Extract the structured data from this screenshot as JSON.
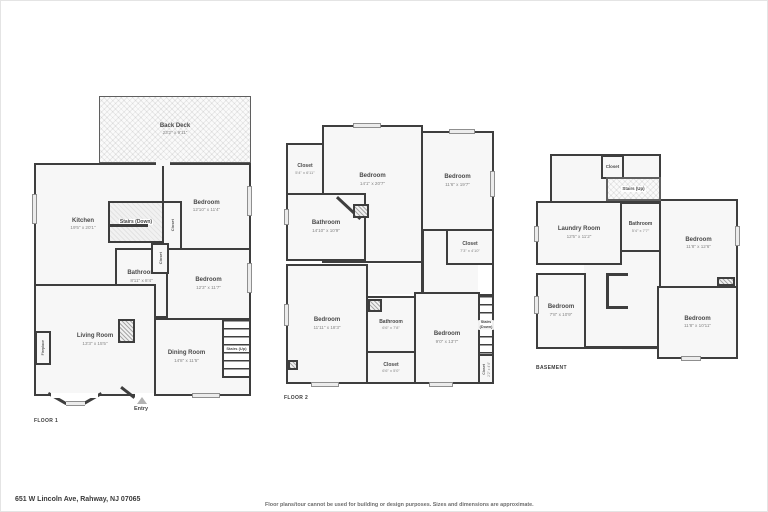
{
  "colors": {
    "wall": "#3e3e3e",
    "room_fill": "#f7f7f7",
    "window": "#ececec",
    "entry_marker": "#b2b2b2"
  },
  "footer": {
    "address": "651 W Lincoln Ave, Rahway, NJ 07065",
    "disclaimer": "Floor plans/tour cannot be used for building or design purposes. Sizes and dimensions are approximate."
  },
  "floor1": {
    "label": "FLOOR 1",
    "entry": "Entry",
    "rooms": {
      "back_deck": {
        "name": "Back Deck",
        "dims": "23'2\" x 9'11\""
      },
      "kitchen": {
        "name": "Kitchen",
        "dims": "19'5\" x 20'1\""
      },
      "bedroom_top": {
        "name": "Bedroom",
        "dims": "12'10\" x 11'4\""
      },
      "stairs_down": {
        "name": "Stairs (Down)"
      },
      "closet_1": {
        "name": "Closet"
      },
      "closet_2": {
        "name": "Closet"
      },
      "bathroom": {
        "name": "Bathroom",
        "dims": "8'11\" x 8'4\""
      },
      "bedroom_right": {
        "name": "Bedroom",
        "dims": "12'3\" x 11'7\""
      },
      "living_room": {
        "name": "Living Room",
        "dims": "13'3\" x 15'5\""
      },
      "dining_room": {
        "name": "Dining Room",
        "dims": "14'8\" x 11'5\""
      },
      "stairs_up": {
        "name": "Stairs (Up)"
      },
      "fireplace": {
        "name": "Fireplace"
      }
    }
  },
  "floor2": {
    "label": "FLOOR 2",
    "rooms": {
      "closet_tl": {
        "name": "Closet",
        "dims": "5'4\" x 6'11\""
      },
      "bedroom_center": {
        "name": "Bedroom",
        "dims": "14'1\" x 20'7\""
      },
      "bedroom_right": {
        "name": "Bedroom",
        "dims": "11'6\" x 19'7\""
      },
      "bathroom_top": {
        "name": "Bathroom",
        "dims": "14'10\" x 10'9\""
      },
      "closet_right": {
        "name": "Closet",
        "dims": "7'3\" x 4'10\""
      },
      "bedroom_left": {
        "name": "Bedroom",
        "dims": "11'11\" x 18'3\""
      },
      "bathroom_mid": {
        "name": "Bathroom",
        "dims": "6'6\" x 7'8\""
      },
      "bedroom_mid": {
        "name": "Bedroom",
        "dims": "9'0\" x 13'7\""
      },
      "closet_mid": {
        "name": "Closet",
        "dims": "6'6\" x 5'0\""
      },
      "stairs_down": {
        "name": "Stairs (Down)"
      },
      "closet_br": {
        "name": "Closet",
        "dims": "2'2\" x 4'4\""
      }
    }
  },
  "basement": {
    "label": "BASEMENT",
    "rooms": {
      "closet": {
        "name": "Closet"
      },
      "stairs_up": {
        "name": "Stairs (Up)"
      },
      "laundry": {
        "name": "Laundry Room",
        "dims": "12'5\" x 11'2\""
      },
      "bathroom": {
        "name": "Bathroom",
        "dims": "5'4\" x 7'7\""
      },
      "bedroom_tr": {
        "name": "Bedroom",
        "dims": "11'8\" x 12'6\""
      },
      "bedroom_bl": {
        "name": "Bedroom",
        "dims": "7'8\" x 10'9\""
      },
      "bedroom_br": {
        "name": "Bedroom",
        "dims": "11'8\" x 10'11\""
      }
    }
  }
}
